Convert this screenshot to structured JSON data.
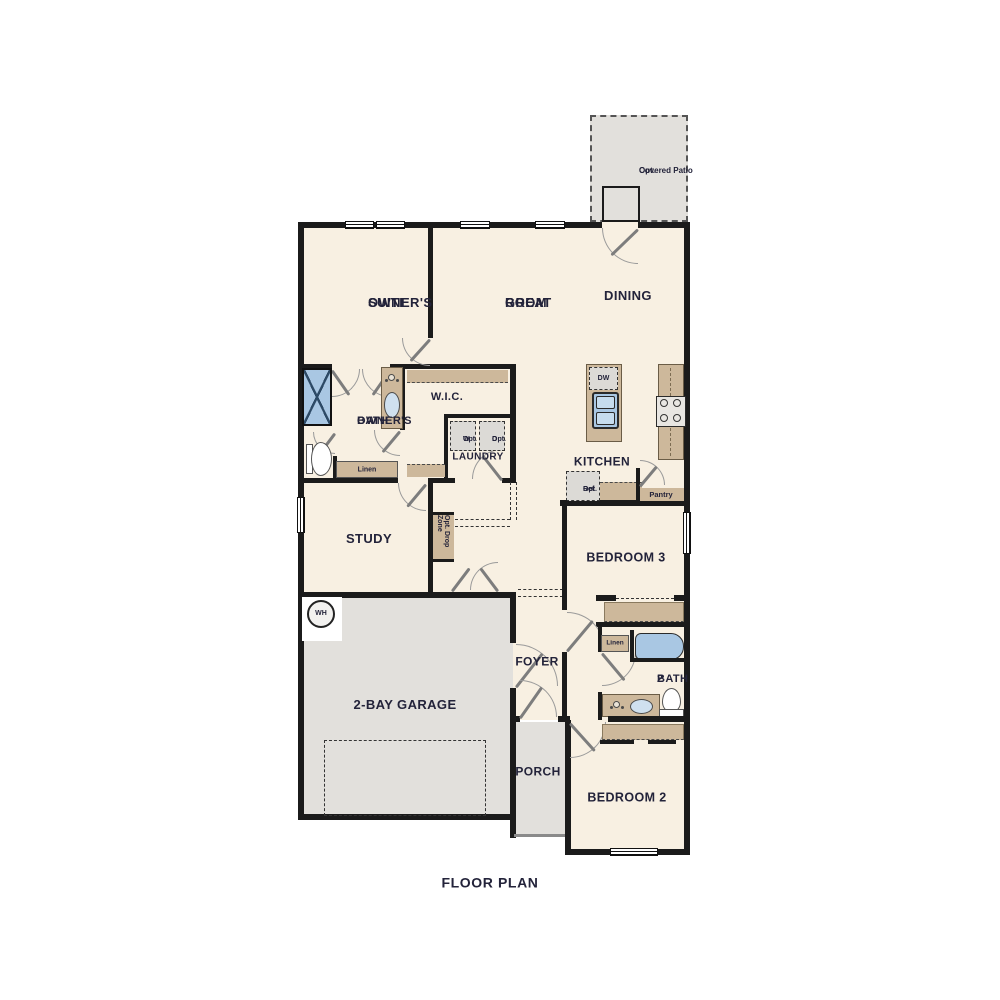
{
  "title": "FLOOR PLAN",
  "colors": {
    "floor": "#f8f0e2",
    "hard_surface": "#e2e0dc",
    "cabinet_tan": "#cdb89b",
    "wall": "#1b1b1b",
    "fixture_blue": "#a9c7e3",
    "label_text": "#23233a"
  },
  "rooms": {
    "patio": {
      "line1": "Opt.",
      "line2": "Covered Patio"
    },
    "owners_suite": {
      "line1": "OWNER'S",
      "line2": "SUITE"
    },
    "great_room": {
      "line1": "GREAT",
      "line2": "ROOM"
    },
    "dining": {
      "label": "DINING"
    },
    "owners_bath": {
      "line1": "OWNER'S",
      "line2": "BATH"
    },
    "wic": {
      "label": "W.I.C."
    },
    "laundry": {
      "label": "LAUNDRY"
    },
    "kitchen": {
      "label": "KITCHEN"
    },
    "pantry": {
      "label": "Pantry"
    },
    "study": {
      "label": "STUDY"
    },
    "bedroom3": {
      "label": "BEDROOM 3"
    },
    "foyer": {
      "label": "FOYER"
    },
    "bath2": {
      "line1": "BATH",
      "line2": "2"
    },
    "garage": {
      "label": "2-BAY GARAGE"
    },
    "porch": {
      "label": "PORCH"
    },
    "bedroom2": {
      "label": "BEDROOM 2"
    }
  },
  "annotations": {
    "linen_owners": "Linen",
    "linen_bath2": "Linen",
    "opt_w_line1": "Opt.",
    "opt_w_line2": "W",
    "opt_d_line1": "Opt.",
    "opt_d_line2": "D",
    "opt_ref_line1": "Opt.",
    "opt_ref_line2": "Ref",
    "opt_drop_zone": "Opt. Drop Zone",
    "dishwasher": "DW",
    "water_heater": "WH"
  }
}
